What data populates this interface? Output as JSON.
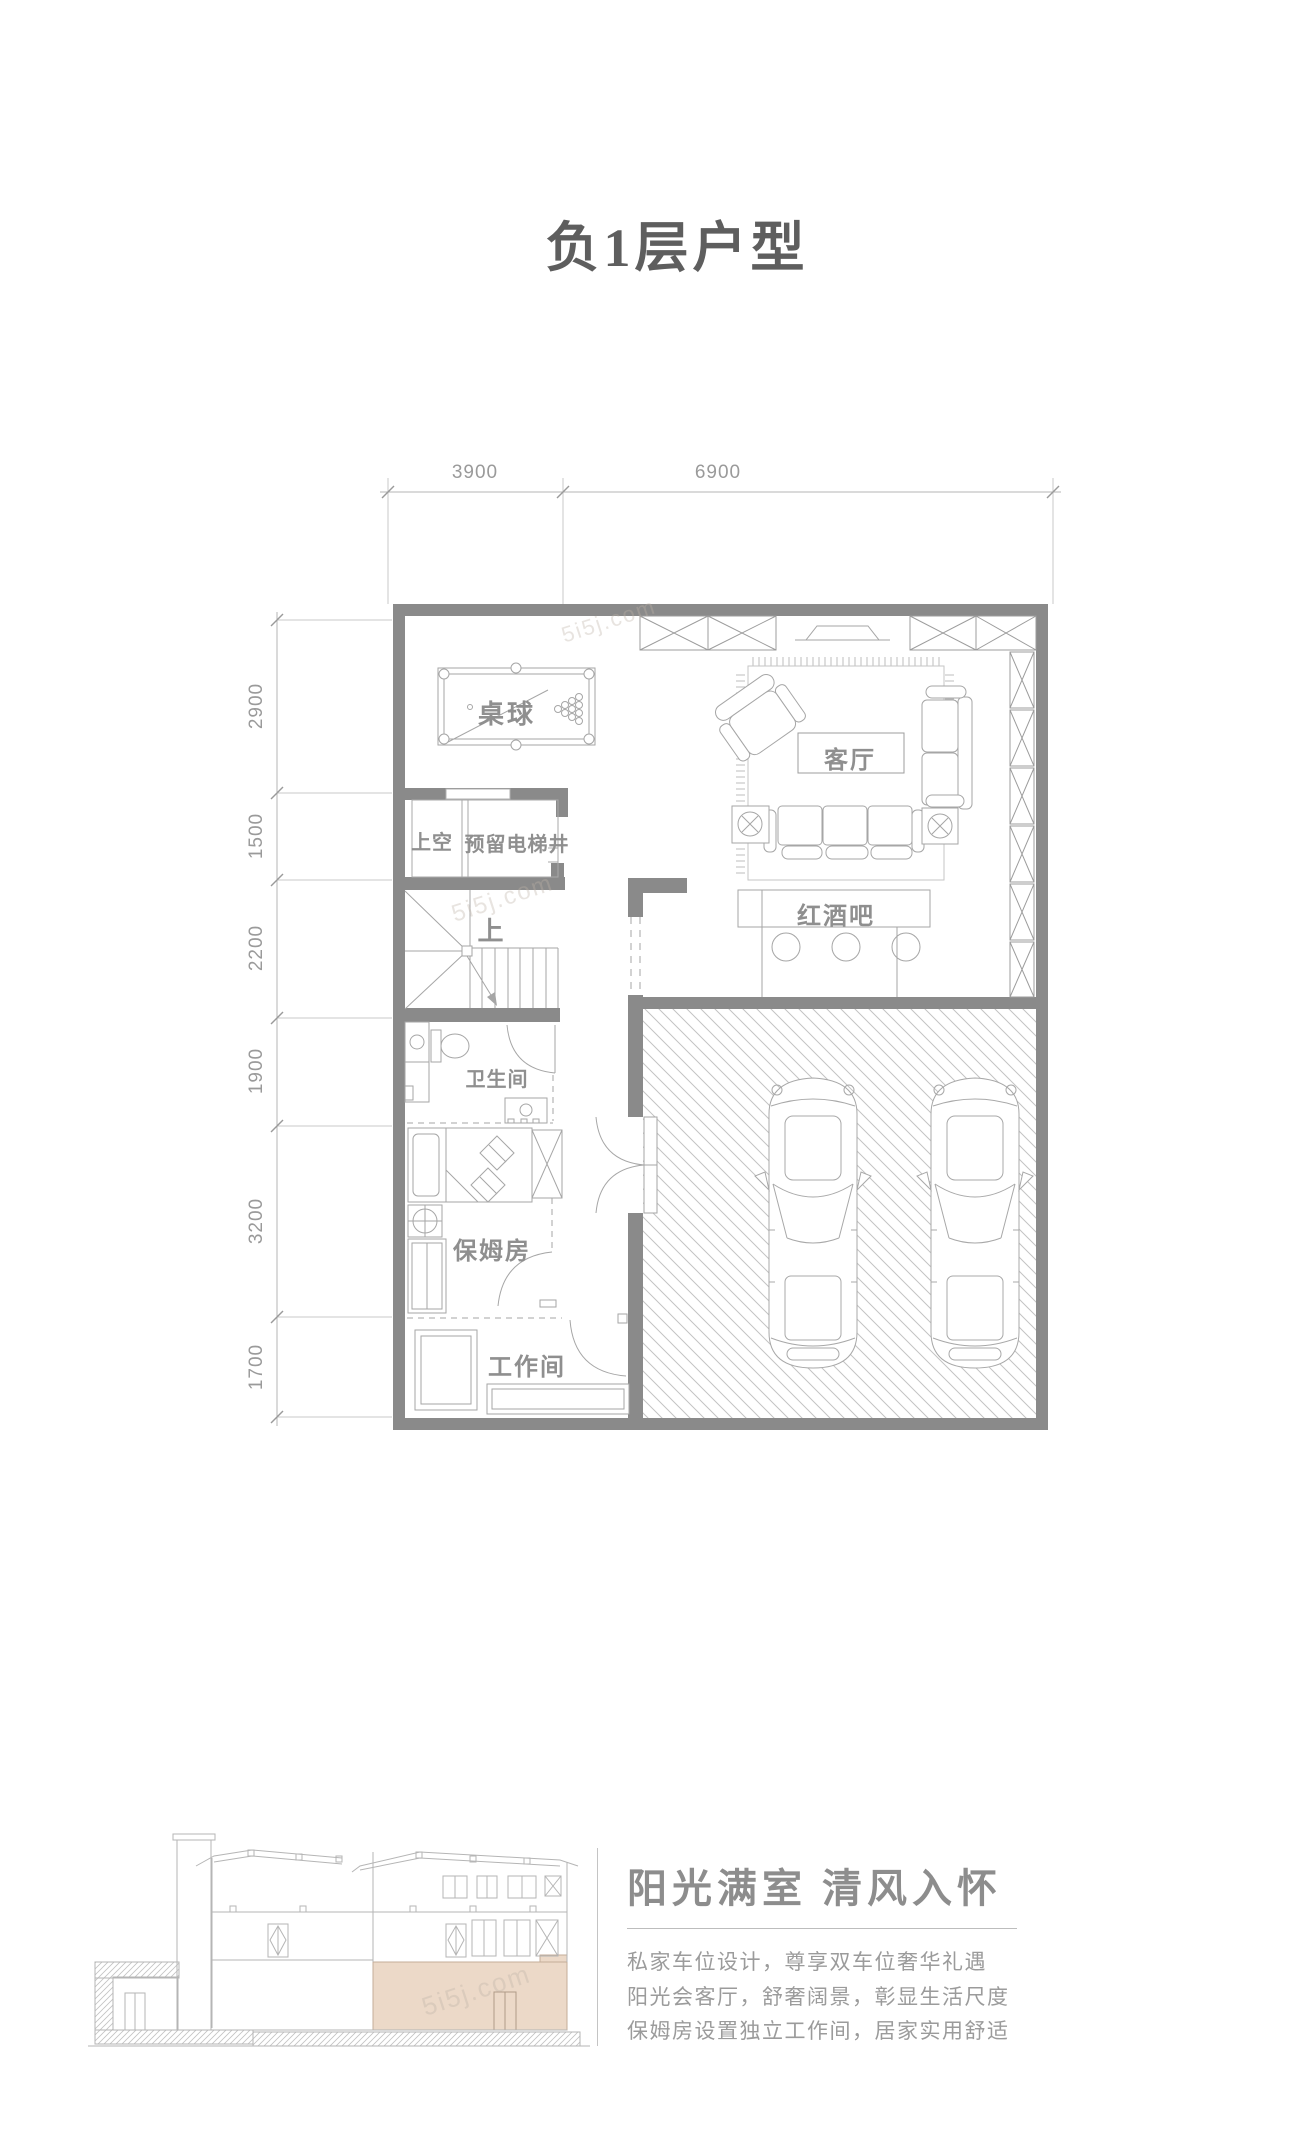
{
  "page": {
    "title": "负1层户型",
    "watermark": "5i5j.com"
  },
  "plan": {
    "dims_top": [
      "3900",
      "6900"
    ],
    "dims_left": [
      "2900",
      "1500",
      "2200",
      "1900",
      "3200",
      "1700"
    ],
    "rooms": {
      "billiards": "桌球",
      "living": "客厅",
      "void": "上空",
      "elevator": "预留电梯井",
      "stairs_up": "上",
      "wine_bar": "红酒吧",
      "bathroom": "卫生间",
      "nanny": "保姆房",
      "workroom": "工作间"
    }
  },
  "marketing": {
    "headline": "阳光满室 清风入怀",
    "lines": [
      "私家车位设计，尊享双车位奢华礼遇",
      "阳光会客厅，舒奢阔景，彰显生活尺度",
      "保姆房设置独立工作间，居家实用舒适"
    ]
  },
  "colors": {
    "wall": "#8a8a8a",
    "furniture_line": "#a6a6a6",
    "thin_line": "#b5b5b5",
    "hatch_line": "#c3c3c3",
    "title_text": "#5e5e5e",
    "label_text": "#8f8f8f",
    "body_text": "#9b9b9b",
    "section_highlight": "#ecd9c8"
  }
}
